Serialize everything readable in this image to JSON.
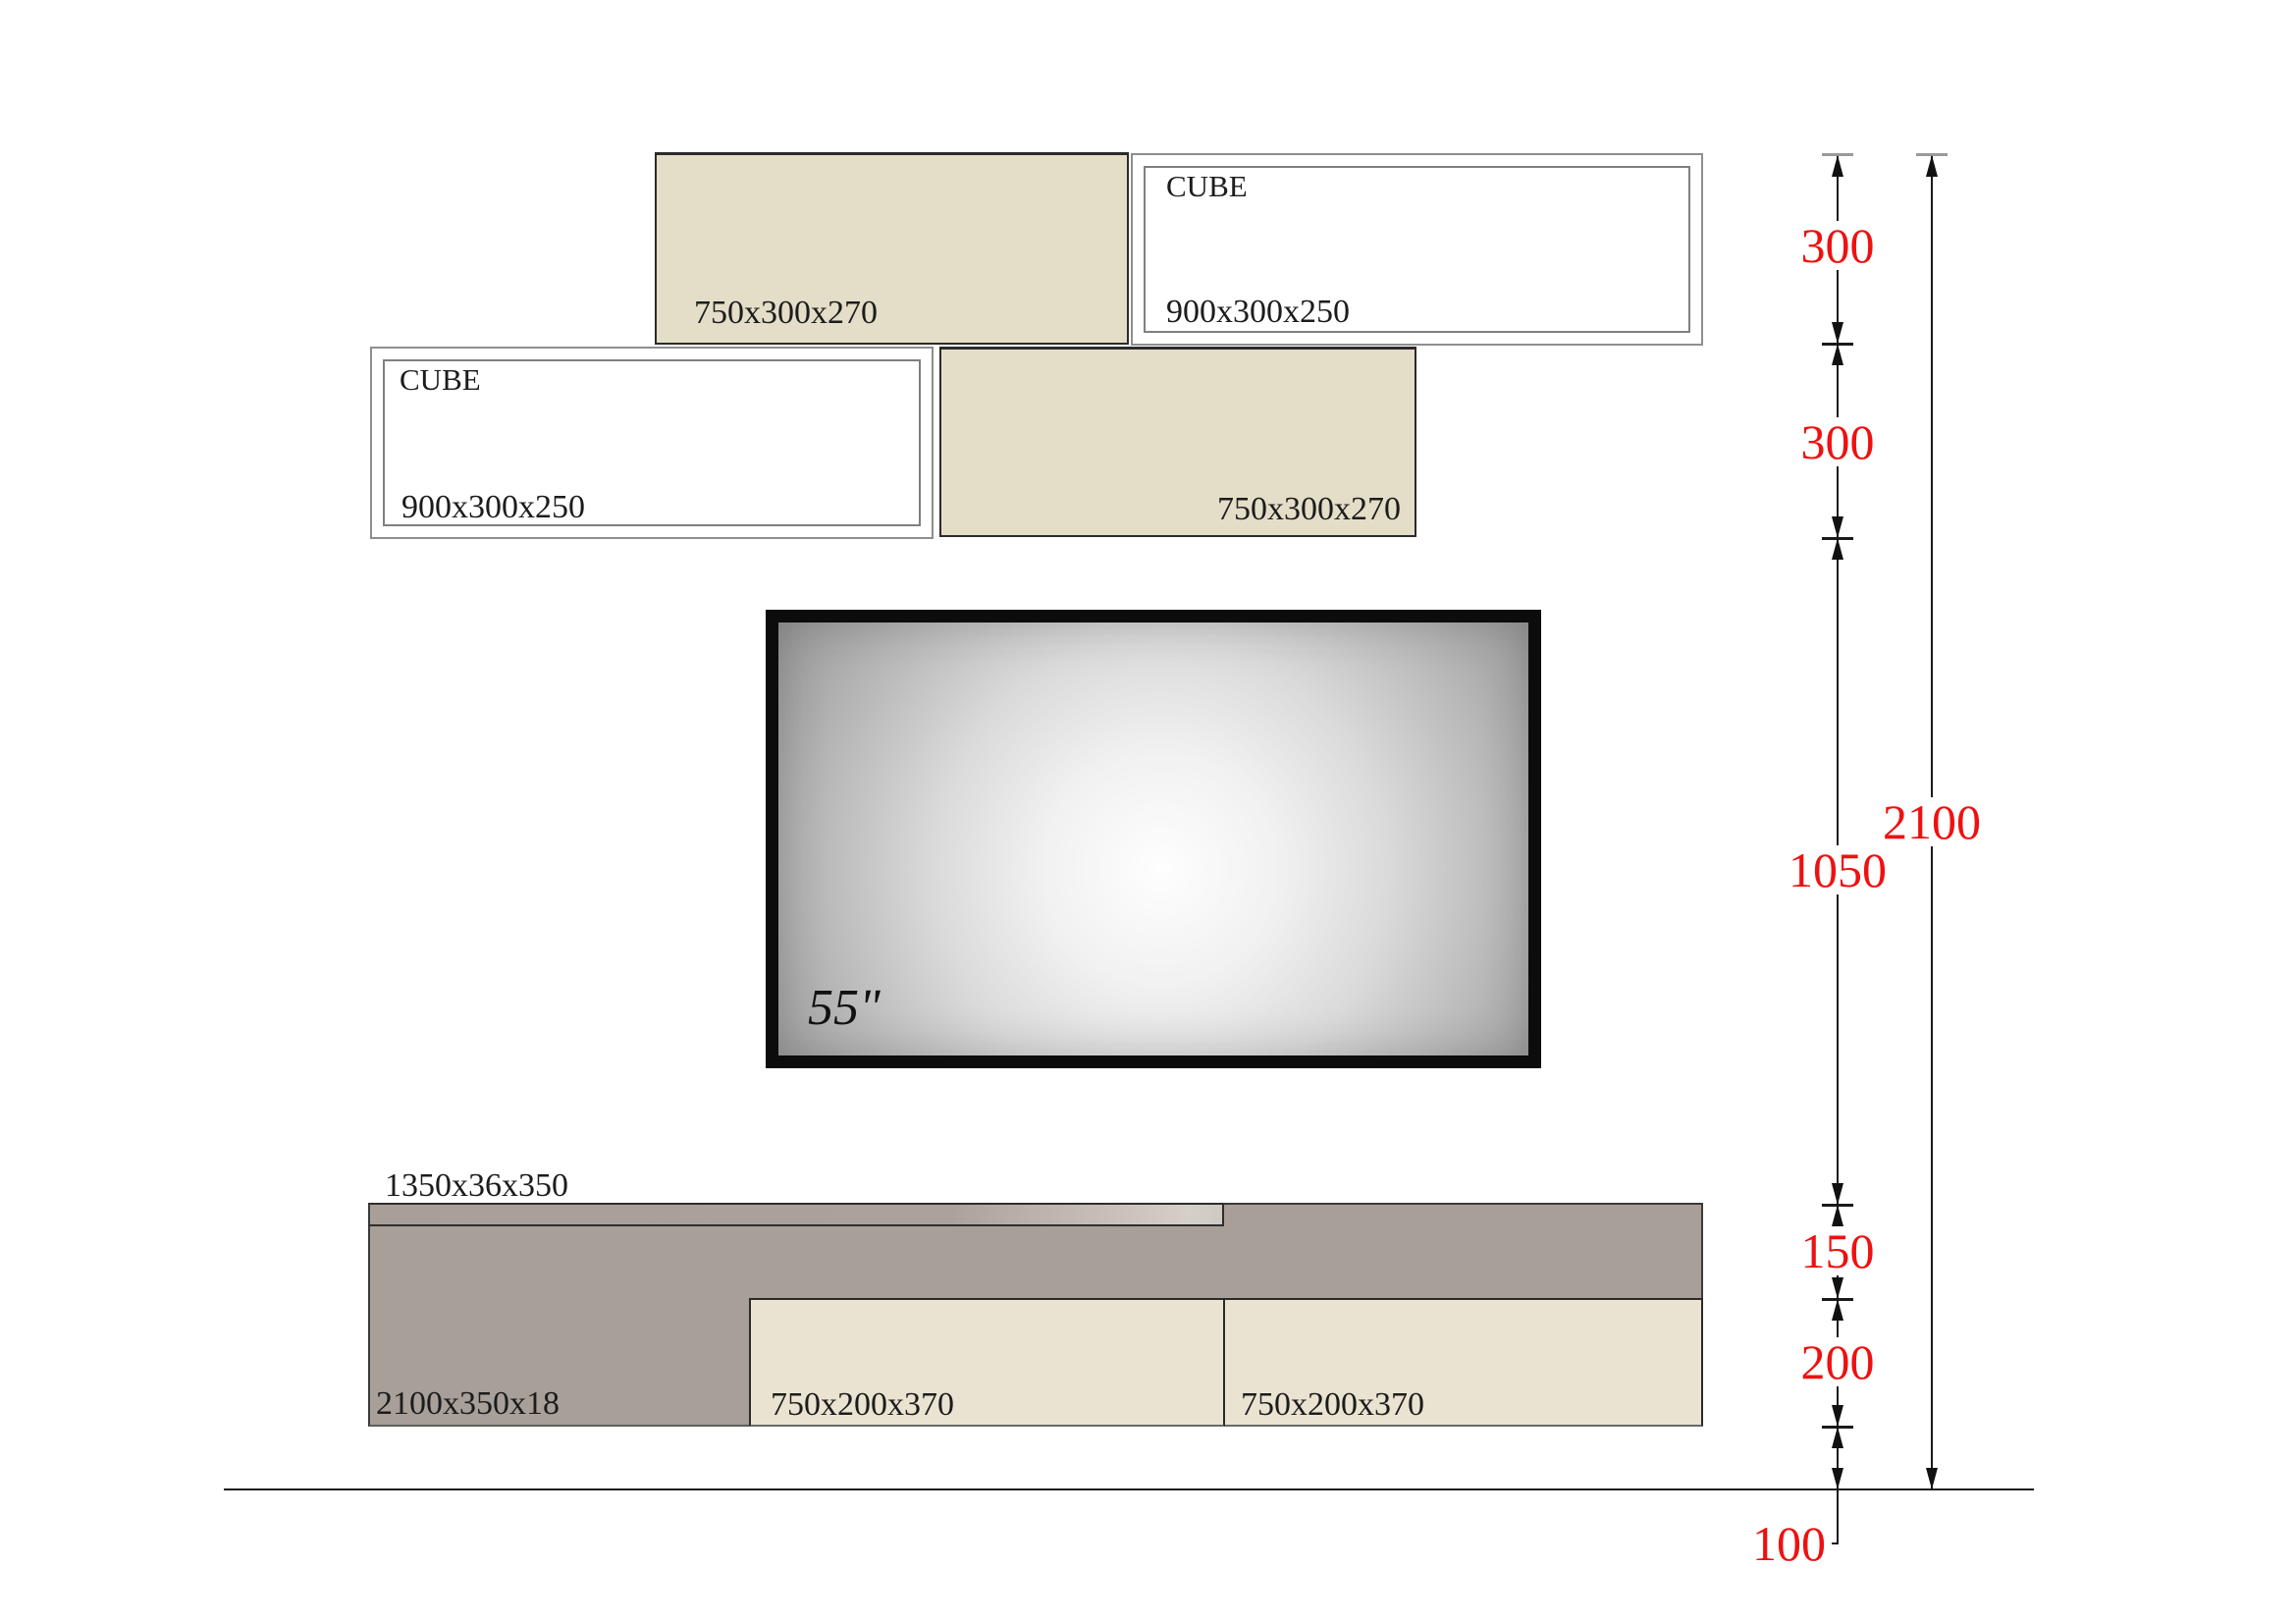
{
  "cubes": {
    "shelf_top": {
      "label": "750x300x270"
    },
    "cube_right": {
      "title": "CUBE",
      "label": "900x300x250"
    },
    "cube_left": {
      "title": "CUBE",
      "label": "900x300x250"
    },
    "shelf_mid": {
      "label": "750x300x270"
    }
  },
  "tv": {
    "size_label": "55\""
  },
  "unit": {
    "shelf_label": "1350x36x350",
    "panel_label": "2100x350x18",
    "drawer_left_label": "750x200x370",
    "drawer_right_label": "750x200x370"
  },
  "dims": {
    "segments": [
      {
        "label": "300"
      },
      {
        "label": "300"
      },
      {
        "label": "1050"
      },
      {
        "label": "150"
      },
      {
        "label": "200"
      }
    ],
    "total_label": "2100",
    "floor_label": "100"
  },
  "colors": {
    "beige": "#e4ddc7",
    "drawer_beige": "#eae3d1",
    "panel_gray": "#a89f99",
    "dim_red": "#ee1111",
    "line_black": "#1a1a1a"
  }
}
